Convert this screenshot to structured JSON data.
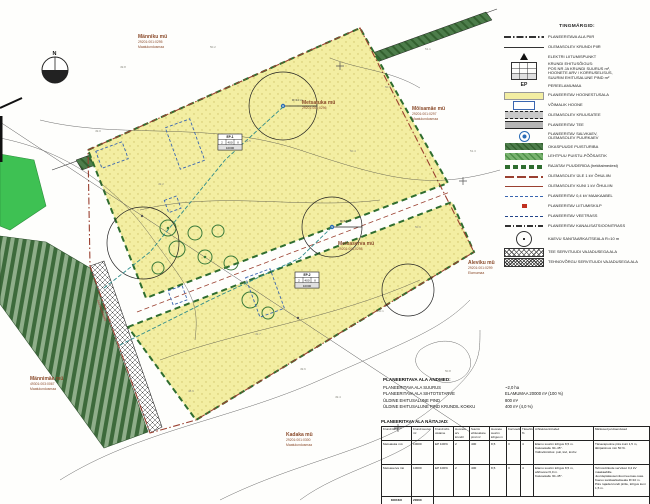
{
  "colors": {
    "parcel_yellow": "#f3eea2",
    "conifer_green": "#4d7d4b",
    "bright_green": "#3ec153",
    "label_brown": "#8a4a2a",
    "boundary_red": "#9a4030",
    "utility_teal": "#2e8b8b",
    "cable_blue": "#3a66b0"
  },
  "map": {
    "compass": "N",
    "road_label": "Juurdepääsutee",
    "radius_label": "R=10 m",
    "labels": [
      {
        "name": "Männiku mü",
        "code": "29201:001:0295",
        "use": "Maatulundusmaa"
      },
      {
        "name": "Metsatuka mü",
        "code": "29201:001:0296",
        "use": ""
      },
      {
        "name": "Mõisamäe mü",
        "code": "29201:001:0297",
        "use": "Maatulundusmaa"
      },
      {
        "name": "Metsaserva mü",
        "code": "29201:001:0298",
        "use": ""
      },
      {
        "name": "Aleviku mü",
        "code": "29201:001:0299",
        "use": "Elamumaa"
      },
      {
        "name": "Kadaka mü",
        "code": "29201:001:0300",
        "use": "Maatulundusmaa"
      },
      {
        "name": "Männimäe mü",
        "code": "49301:003:0067",
        "use": "Maatulundusmaa"
      }
    ],
    "ep_boxes": [
      {
        "pos": "EP-1",
        "houses": "2",
        "bp": "400",
        "floors": "II",
        "size": "10000"
      },
      {
        "pos": "EP-2",
        "houses": "2",
        "bp": "400",
        "floors": "II",
        "size": "10000"
      }
    ],
    "spot_heights": [
      "49.8",
      "50.2",
      "50.6",
      "51.1",
      "49.5",
      "49.2",
      "50.4",
      "50.9",
      "49.7",
      "50.1",
      "48.9",
      "49.4",
      "50.8",
      "49.0",
      "51.3",
      "49.6"
    ]
  },
  "legend": {
    "title": "TINGMÄRGID:",
    "items": [
      {
        "sym": "area-boundary",
        "label": "PLANEERITAVA ALA PIIR"
      },
      {
        "sym": "plot-boundary",
        "label": "OLEMASOLEV KRUNDI PIIR"
      },
      {
        "sym": "triangle",
        "label": "ELEKTRI LIITUMISPUNKT"
      },
      {
        "sym": "ep-box",
        "label": "KRUNDI EHITUSÕIGUS:\nPOS NR JA KRUNDI SUURUS m²,\nHOONETE ARV / KORRUSELISUS,\nSUURIM EHITUSALUNE PIND m²"
      },
      {
        "sym": "ep-text",
        "symtext": "EP",
        "label": "PEREELAMUMAA"
      },
      {
        "sym": "yellow-band",
        "label": "PLANEERITAV HOONESTUSALA"
      },
      {
        "sym": "house-rect",
        "label": "VÕIMALIK HOONE"
      },
      {
        "sym": "gravel-road",
        "label": "OLEMASOLEV KRUUSATEE"
      },
      {
        "sym": "new-road",
        "label": "PLANEERITAV TEE"
      },
      {
        "sym": "wells",
        "label": "PLANEERITAV SALVKAEV,\nOLEMASOLEV PUURKAEV"
      },
      {
        "sym": "conifer-band",
        "label": "OKASPUUDE PUISTURIBA"
      },
      {
        "sym": "decid-band",
        "label": "LEHTPUU PUISTU-PÕÕSASTIK"
      },
      {
        "sym": "treerow-band",
        "label": "RAJATAV PUUDERIDA (hekitaimedest)"
      },
      {
        "sym": "ohl-high",
        "label": "OLEMASOLEV ÜLE 1 kV ÕHULIIN"
      },
      {
        "sym": "ohl-low",
        "label": "OLEMASOLEV KUNI 1 kV ÕHULIIN"
      },
      {
        "sym": "cable",
        "label": "PLANEERITAV 0,4 kV MAAKAABEL"
      },
      {
        "sym": "kilp",
        "label": "PLANEERITAV LIITUMISKILP"
      },
      {
        "sym": "water-line",
        "label": "PLANEERITAV VEETRASS"
      },
      {
        "sym": "sewer-line",
        "label": "PLANEERITAV KANALISATSIOONITRASS"
      },
      {
        "sym": "kuja-circle",
        "label": "KAEVU SANITAARKAITSEALA R=10 m"
      },
      {
        "sym": "serv-road",
        "label": "TEE SERVITUUDI VAJADUSEGA ALA"
      },
      {
        "sym": "serv-tech",
        "label": "TEHNOVÕRGU SERVITUUDI VAJADUSEGA ALA"
      }
    ]
  },
  "summary": {
    "title": "PLANEERITAVA ALA ANDMED:",
    "rows": [
      {
        "label": "PLANEERITAVA ALA SUURUS",
        "value": "~2,0 ha"
      },
      {
        "label": "PLANEERITAVA ALA SIHTOTSTARVE",
        "value": "ELAMUMAA 20000 m² (100 %)"
      },
      {
        "label": "ÜLDINE EHITUSALUNE PIND",
        "value": "800 m²"
      },
      {
        "label": "ÜLDINE EHITUSALUNE PIND KRUNDIL KOKKU",
        "value": "400 m² (4,0 %)"
      }
    ]
  },
  "table": {
    "title": "PLANEERITAVA ALA NÄITAJAD:",
    "headers": [
      "Krundi tähis",
      "Krundi suurus m²",
      "Krundi siht-otstarve",
      "Hoonete arv krundil",
      "Suurim ehitusalune pind m²",
      "Hoonete suurim kõrgus m",
      "Korruselisus",
      "Täisehitus %",
      "Arhitektuurinõuded",
      "Märkused ja kitsendused"
    ],
    "rows": [
      [
        "Metsatuka mü",
        "10000",
        "EP 100%",
        "2",
        "400",
        "8,5",
        "II",
        "4",
        "Elamu suurim kõrgus 8,5 m.\nKatusekalle 30–45°.\nVälisviimistlus: puit, kivi, krohv.",
        "Tänavapoolne piire kuni 1,5 m,\nläbipaistvus min 50 %."
      ],
      [
        "Metsaserva mü",
        "10000",
        "EP 100%",
        "2",
        "400",
        "8,5",
        "II",
        "4",
        "Elamu suurim kõrgus 8,5 m,\nabihoonel 6,0 m.\nKatusekalle 30–45°.",
        "Tehnovõrkude servituut 0,4 kV maakaablile.\nJuurdepääsuservituut teemaa osas.\nKaevu sanitaarkaitseala R=10 m.\nPiire rajada krundi piirile, kõrgus kuni 1,5 m."
      ]
    ],
    "total_label": "KOKKU",
    "total_value": "20000"
  }
}
